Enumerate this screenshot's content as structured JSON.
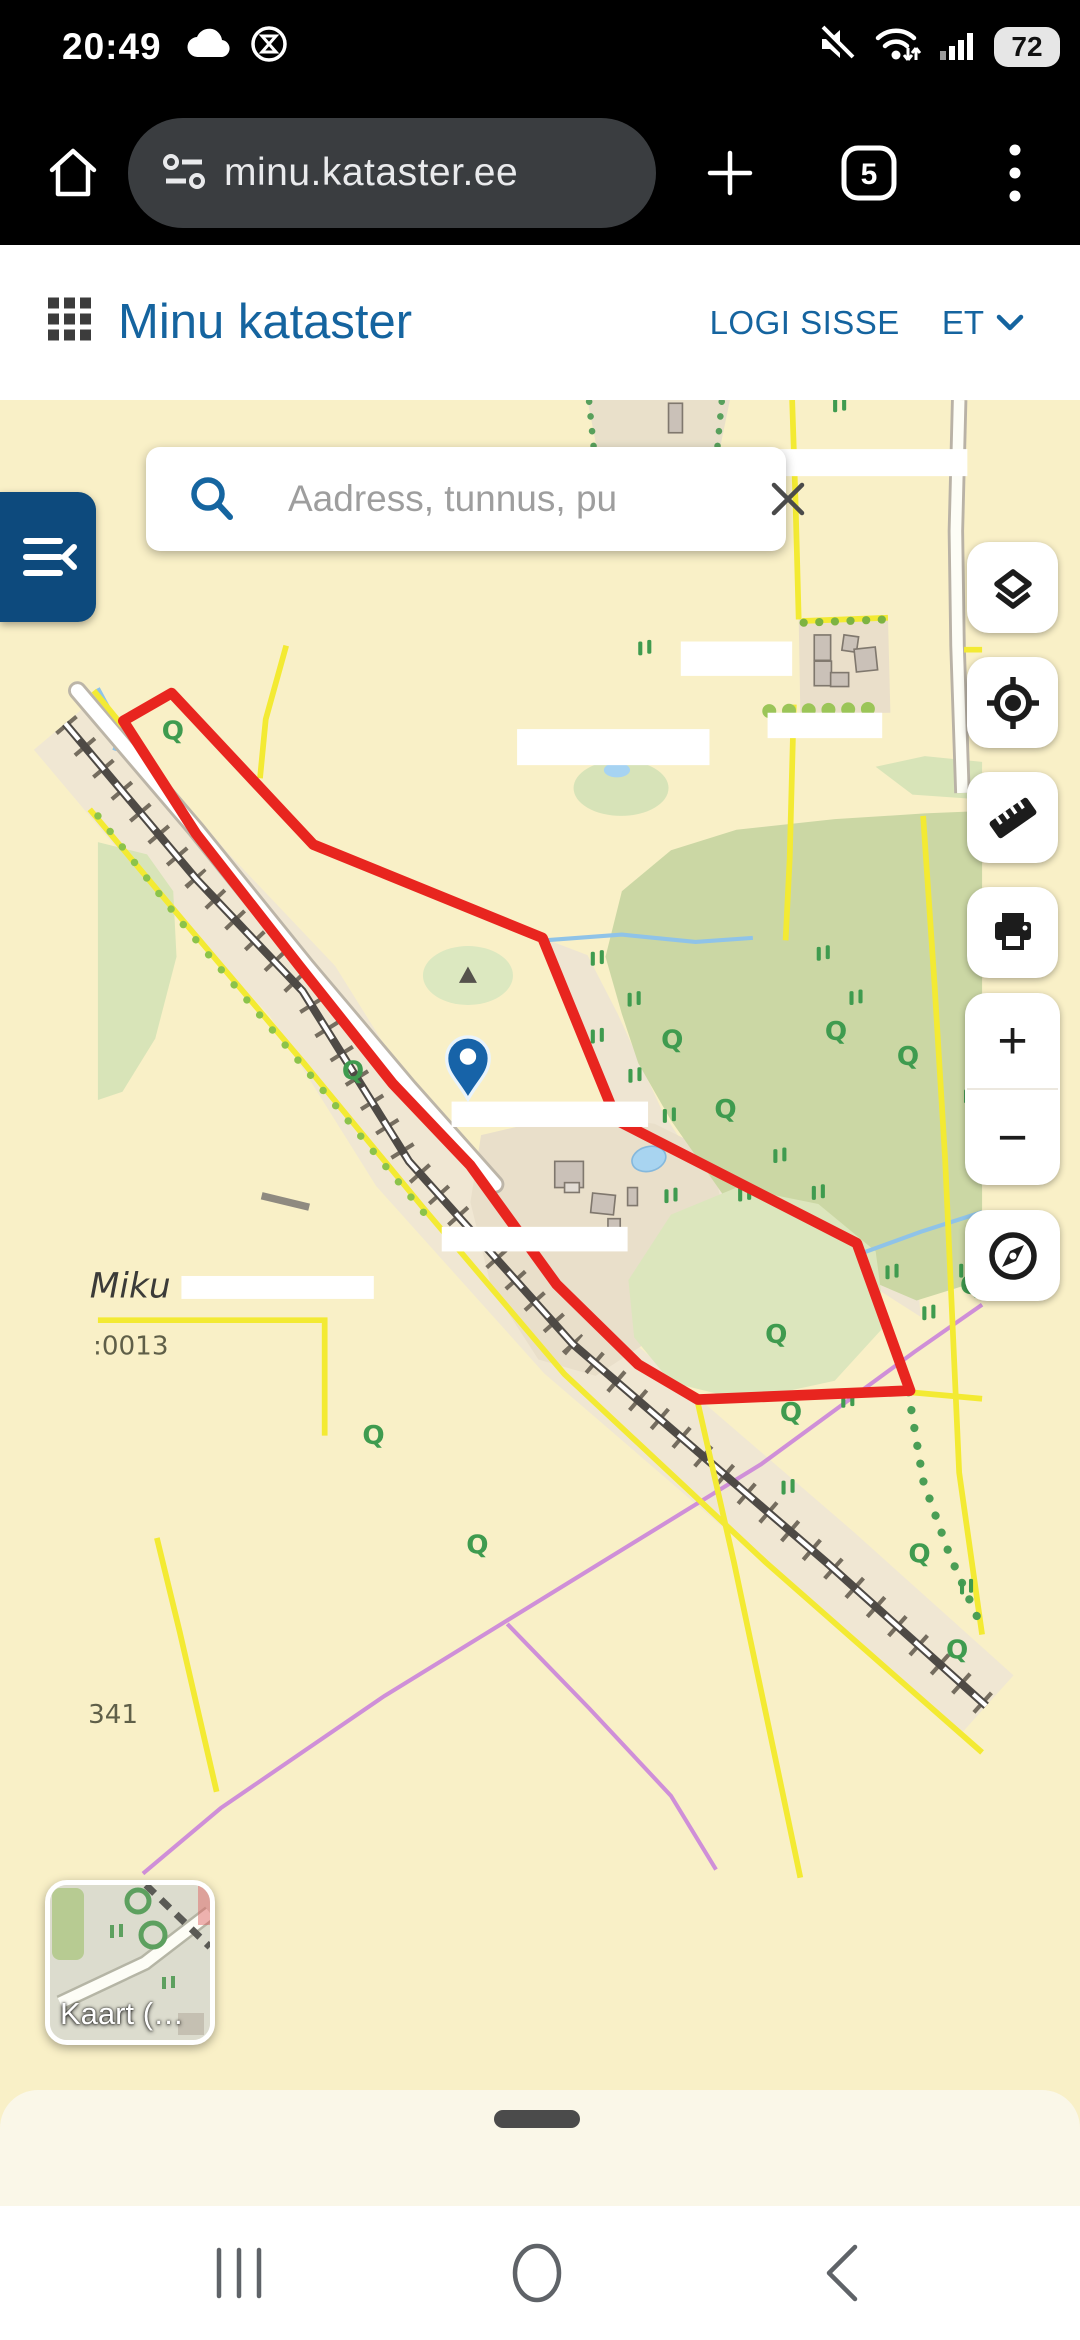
{
  "status_bar": {
    "time": "20:49",
    "battery_percent": "72"
  },
  "browser": {
    "url": "minu.kataster.ee",
    "tab_count": "5"
  },
  "header": {
    "title": "Minu kataster",
    "login_label": "LOGI SISSE",
    "language": "ET"
  },
  "search": {
    "placeholder": "Aadress, tunnus, pu"
  },
  "controls": {
    "zoom_in": "+",
    "zoom_out": "−"
  },
  "map": {
    "labels": {
      "farm_name": "Miku",
      "parcel_code": ":0013",
      "parcel_code_2": "341"
    },
    "symbols": {
      "tree": "Q"
    },
    "basemap_label": "Kaart (…"
  },
  "colors": {
    "accent_blue": "#15649f",
    "panel_navy": "#0d4a7d",
    "parcel_boundary_red": "#e8251f",
    "cadastral_yellow": "#f3ea33",
    "map_background": "#f9f0c7",
    "forest_green": "#cbd7a4",
    "pipeline_purple": "#cf8fd8",
    "pin_blue": "#1763a8"
  }
}
